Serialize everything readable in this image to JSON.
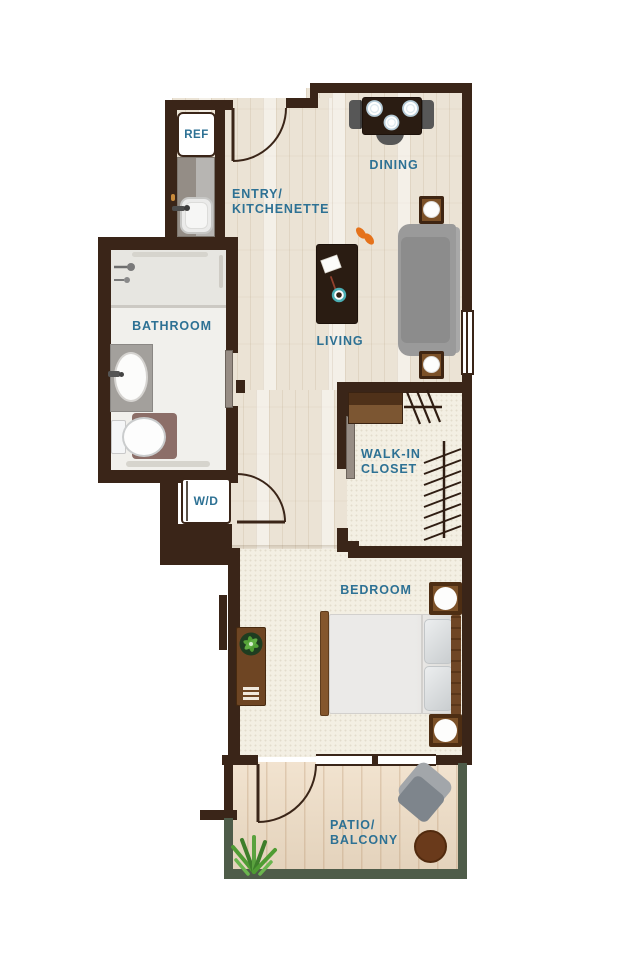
{
  "rooms": {
    "entry_kitchenette": {
      "line1": "ENTRY/",
      "line2": "KITCHENETTE"
    },
    "dining": {
      "label": "DINING"
    },
    "living": {
      "label": "LIVING"
    },
    "bathroom": {
      "label": "BATHROOM"
    },
    "walk_in_closet": {
      "line1": "WALK-IN",
      "line2": "CLOSET"
    },
    "bedroom": {
      "label": "BEDROOM"
    },
    "patio": {
      "line1": "PATIO/",
      "line2": "BALCONY"
    }
  },
  "fixtures": {
    "refrigerator": "REF",
    "washer_dryer": "W/D"
  },
  "colors": {
    "wall": "#3a2518",
    "label_text": "#2d7194",
    "wood_floor": "#ebe3d5",
    "carpet": "#f3efe3",
    "bath_floor": "#f1f0ec",
    "shower_floor": "#e7e6e1",
    "patio_floor": "#efddc5",
    "patio_border": "#4e5c49",
    "counter_gray": "#a3a09c",
    "sofa_gray": "#9a9a9a",
    "dark_table": "#2a1c12",
    "wood_furniture": "#7c5128",
    "slipper_orange": "#e5721b",
    "cup_teal": "#4aaeb4",
    "plant_green": "#54a238"
  }
}
